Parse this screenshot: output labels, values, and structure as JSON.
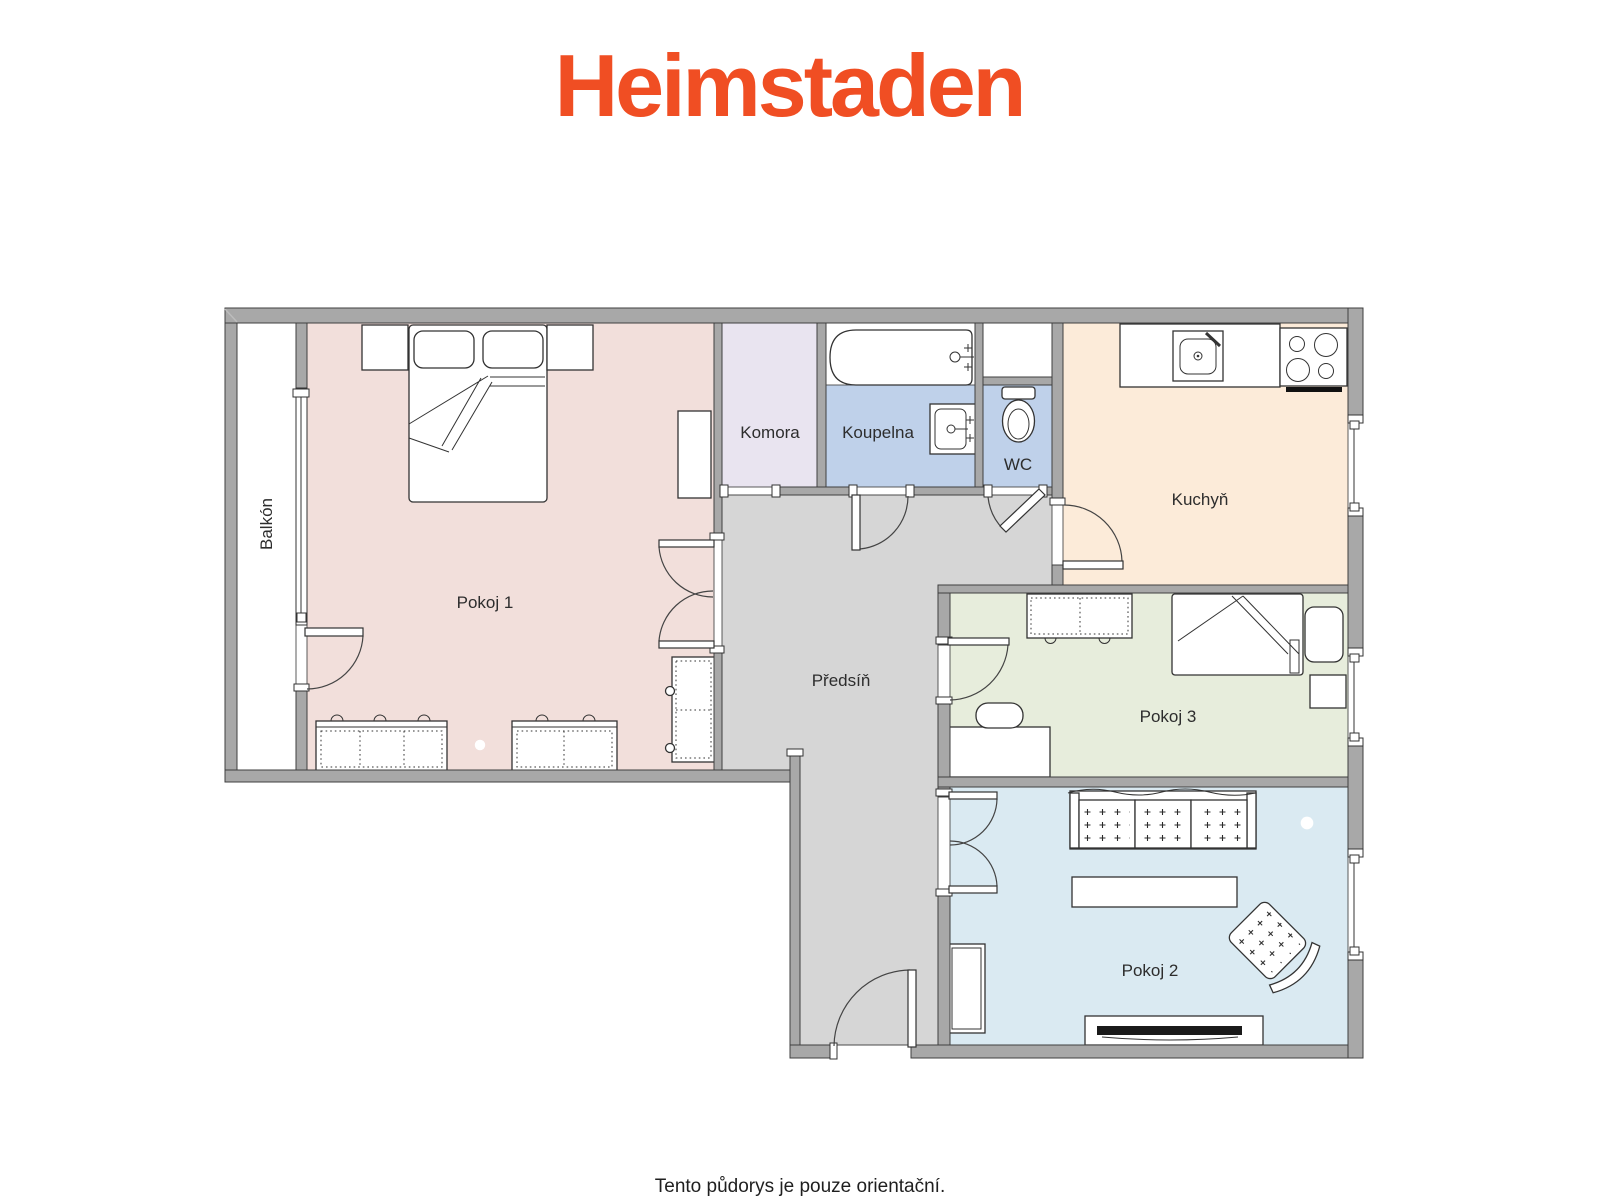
{
  "brand": {
    "name": "Heimstaden",
    "color": "#F04E23"
  },
  "plan": {
    "colors": {
      "wall": "#A8A8A8",
      "tv": "#1A1A1A"
    },
    "rooms": [
      {
        "id": "balkon",
        "label": "Balkón",
        "color": "#FFFFFF"
      },
      {
        "id": "pokoj1",
        "label": "Pokoj 1",
        "color": "#F2DFDB"
      },
      {
        "id": "komora",
        "label": "Komora",
        "color": "#E9E4F0"
      },
      {
        "id": "koupelna",
        "label": "Koupelna",
        "color": "#BFD1EA"
      },
      {
        "id": "wc",
        "label": "WC",
        "color": "#BFD1EA"
      },
      {
        "id": "kuchyn",
        "label": "Kuchyň",
        "color": "#FCEBD9"
      },
      {
        "id": "predsin",
        "label": "Předsíň",
        "color": "#D6D6D6"
      },
      {
        "id": "pokoj3",
        "label": "Pokoj 3",
        "color": "#E7EDDC"
      },
      {
        "id": "pokoj2",
        "label": "Pokoj 2",
        "color": "#DAEAF2"
      }
    ]
  },
  "footer": {
    "disclaimer": "Tento půdorys je pouze orientační."
  }
}
